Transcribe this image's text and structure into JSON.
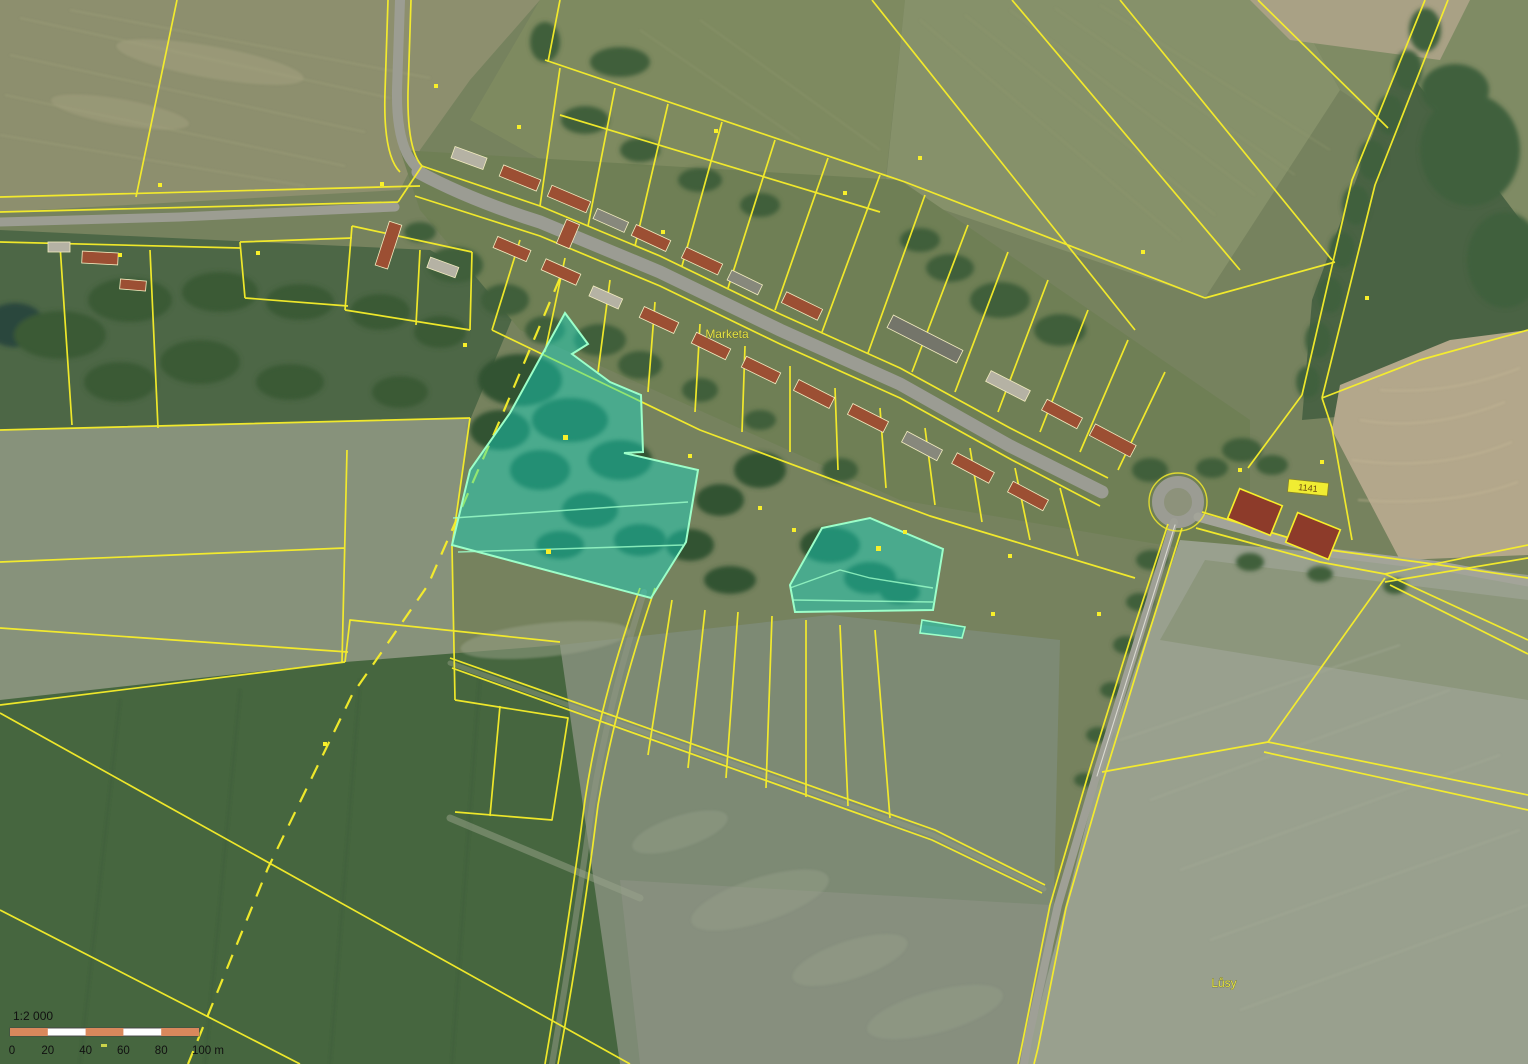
{
  "map": {
    "place_labels": {
      "village": "Marketa",
      "field": "Lůsy"
    },
    "building_label": "1141",
    "colors": {
      "parcel_line": "#f8ef2a",
      "highlight_fill": "#0fe3cf",
      "highlight_stroke": "#9cffc9",
      "scale_bar_orange": "#d9885c"
    }
  },
  "scale_bar": {
    "ratio": "1:2 000",
    "ticks": [
      "0",
      "20",
      "40",
      "60",
      "80",
      "100 m"
    ]
  }
}
